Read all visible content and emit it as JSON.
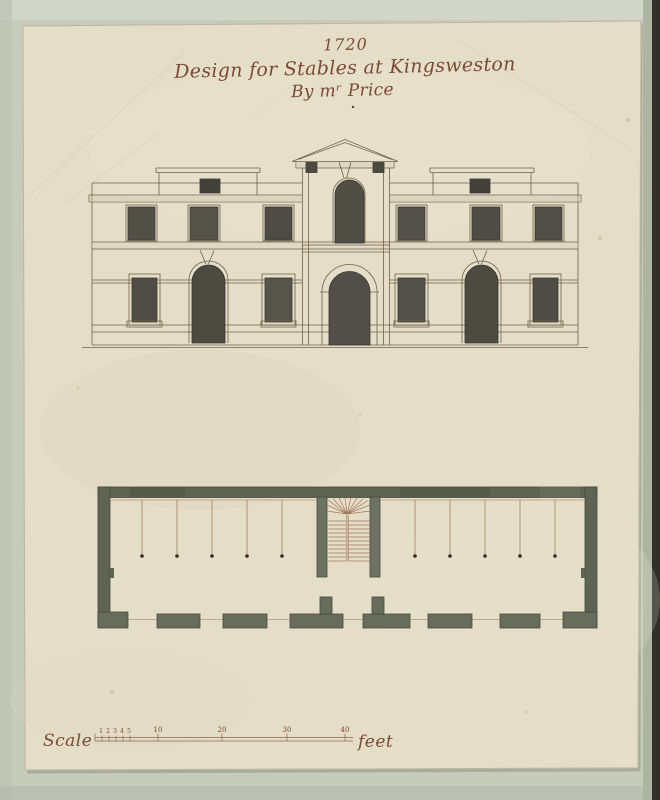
{
  "document": {
    "date": "1720",
    "title": "Design for Stables at Kingsweston",
    "byline": "By mʳ Price"
  },
  "scale_bar": {
    "label": "Scale",
    "unit": "feet",
    "minor_tick_labels": [
      "1",
      "2",
      "3",
      "4",
      "5"
    ],
    "major_tick_labels": [
      "10",
      "20",
      "30",
      "40"
    ]
  },
  "colors": {
    "album_page": "#c6cbbc",
    "photo_edge": "#31312a",
    "sheet_paper": "#e4ddc7",
    "title_ink": "#7b4a34",
    "drawing_ink": "#71624a",
    "window_wash": "#514f46",
    "plan_wall_wash": "#5e6352",
    "stall_line_ink": "#9b7355"
  }
}
